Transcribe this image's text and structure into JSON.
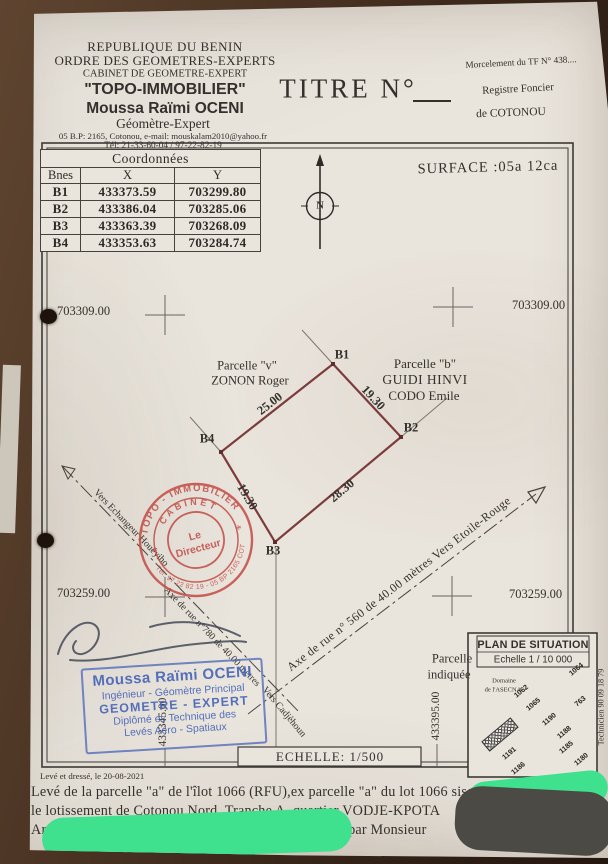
{
  "org": {
    "country": "REPUBLIQUE DU BENIN",
    "order": "ORDRE DES GEOMETRES-EXPERTS",
    "cabinet_type": "CABINET DE GEOMETRE-EXPERT",
    "cabinet_name": "\"TOPO-IMMOBILIER\"",
    "expert_name": "Moussa Raïmi OCENI",
    "expert_title": "Géomètre-Expert",
    "address": "05 B.P: 2165, Cotonou, e-mail: mouskalam2010@yahoo.fr",
    "phone": "Tél: 21-33-60-04 / 97-22-82-19"
  },
  "title_label": "TITRE N°",
  "registry": {
    "morcellement": "Morcelement du TF N° 438....",
    "registre": "Registre Foncier",
    "ville": "de COTONOU"
  },
  "surface_label": "SURFACE :05a 12ca",
  "coords_table": {
    "title": "Coordonnées",
    "headers": [
      "Bnes",
      "X",
      "Y"
    ],
    "rows": [
      {
        "b": "B1",
        "x": "433373.59",
        "y": "703299.80"
      },
      {
        "b": "B2",
        "x": "433386.04",
        "y": "703285.06"
      },
      {
        "b": "B3",
        "x": "433363.39",
        "y": "703268.09"
      },
      {
        "b": "B4",
        "x": "433353.63",
        "y": "703284.74"
      }
    ]
  },
  "plan": {
    "north": "N",
    "grid": {
      "y_top_left": "703309.00",
      "y_top_right": "703309.00",
      "y_bottom_left": "703259.00",
      "y_bottom_right": "703259.00",
      "x_left": "433345.00",
      "x_right": "433395.00"
    },
    "parcel_v": {
      "l1": "Parcelle \"v\"",
      "l2": "ZONON Roger"
    },
    "parcel_b": {
      "l1": "Parcelle \"b\"",
      "l2": "GUIDI HINVI",
      "l3": "CODO Emile"
    },
    "corners": {
      "b1": "B1",
      "b2": "B2",
      "b3": "B3",
      "b4": "B4"
    },
    "sides": {
      "b4b1": "25.00",
      "b1b2": "19.30",
      "b3b2": "28.30",
      "b4b3": "19.30"
    },
    "road_left": {
      "p1": "Vers Echangeur Houéyiho",
      "p2": "Axe de rue n°780 de 40.00 mètres",
      "p3": "Vers Cadjèhoun"
    },
    "road_right": "Axe de rue n° 560 de 40.00 mètres Vers Etoile-Rouge",
    "pointer": {
      "l1": "Parcelle",
      "l2": "indiquée"
    },
    "scale_label": "ECHELLE: 1/500"
  },
  "stamps": {
    "red": {
      "arc_top": "TOPO - IMMOBILIER",
      "arc_mid": "CABINET",
      "arc_bottom": "Tél: 97 22 82 19 - 05 BP 2165 COT",
      "center1": "Le",
      "center2": "Directeur",
      "star": "*"
    },
    "blue": {
      "l1": "Moussa Raïmi OCENI",
      "l2": "Ingénieur - Géomètre Principal",
      "l3": "GEOMETRE - EXPERT",
      "l4": "Diplômé es Technique des",
      "l5": "Levés  Aéro - Spatiaux"
    }
  },
  "inset": {
    "title": "PLAN DE SITUATION",
    "scale": "Echelle 1 / 10 000",
    "domaine1": "Domaine",
    "domaine2": "de l'ASECNA",
    "technician": "Technicien 90 09 18 79",
    "blocks": [
      "1064",
      "1062",
      "763",
      "1065",
      "1190",
      "1188",
      "1185",
      "1180",
      "1191",
      "1186"
    ]
  },
  "footer": {
    "date": "Levé et dressé, le 20-08-2021",
    "line1": "Levé de la  parcelle \"a\" de l'îlot 1066 (RFU),ex parcelle \"a\" du lot 1066 sise dans",
    "line2": "le lotissement de Cotonou Nord, Tranche A, quartier VODJE-KPOTA",
    "line3": "Arrondissement, Commune de COTONOU, demandé par Monsieur"
  },
  "colors": {
    "accent_red": "#c0453f",
    "accent_blue": "#4a67b8",
    "parcel_line": "#7d3c3c",
    "redaction_green": "#3fe08e"
  }
}
